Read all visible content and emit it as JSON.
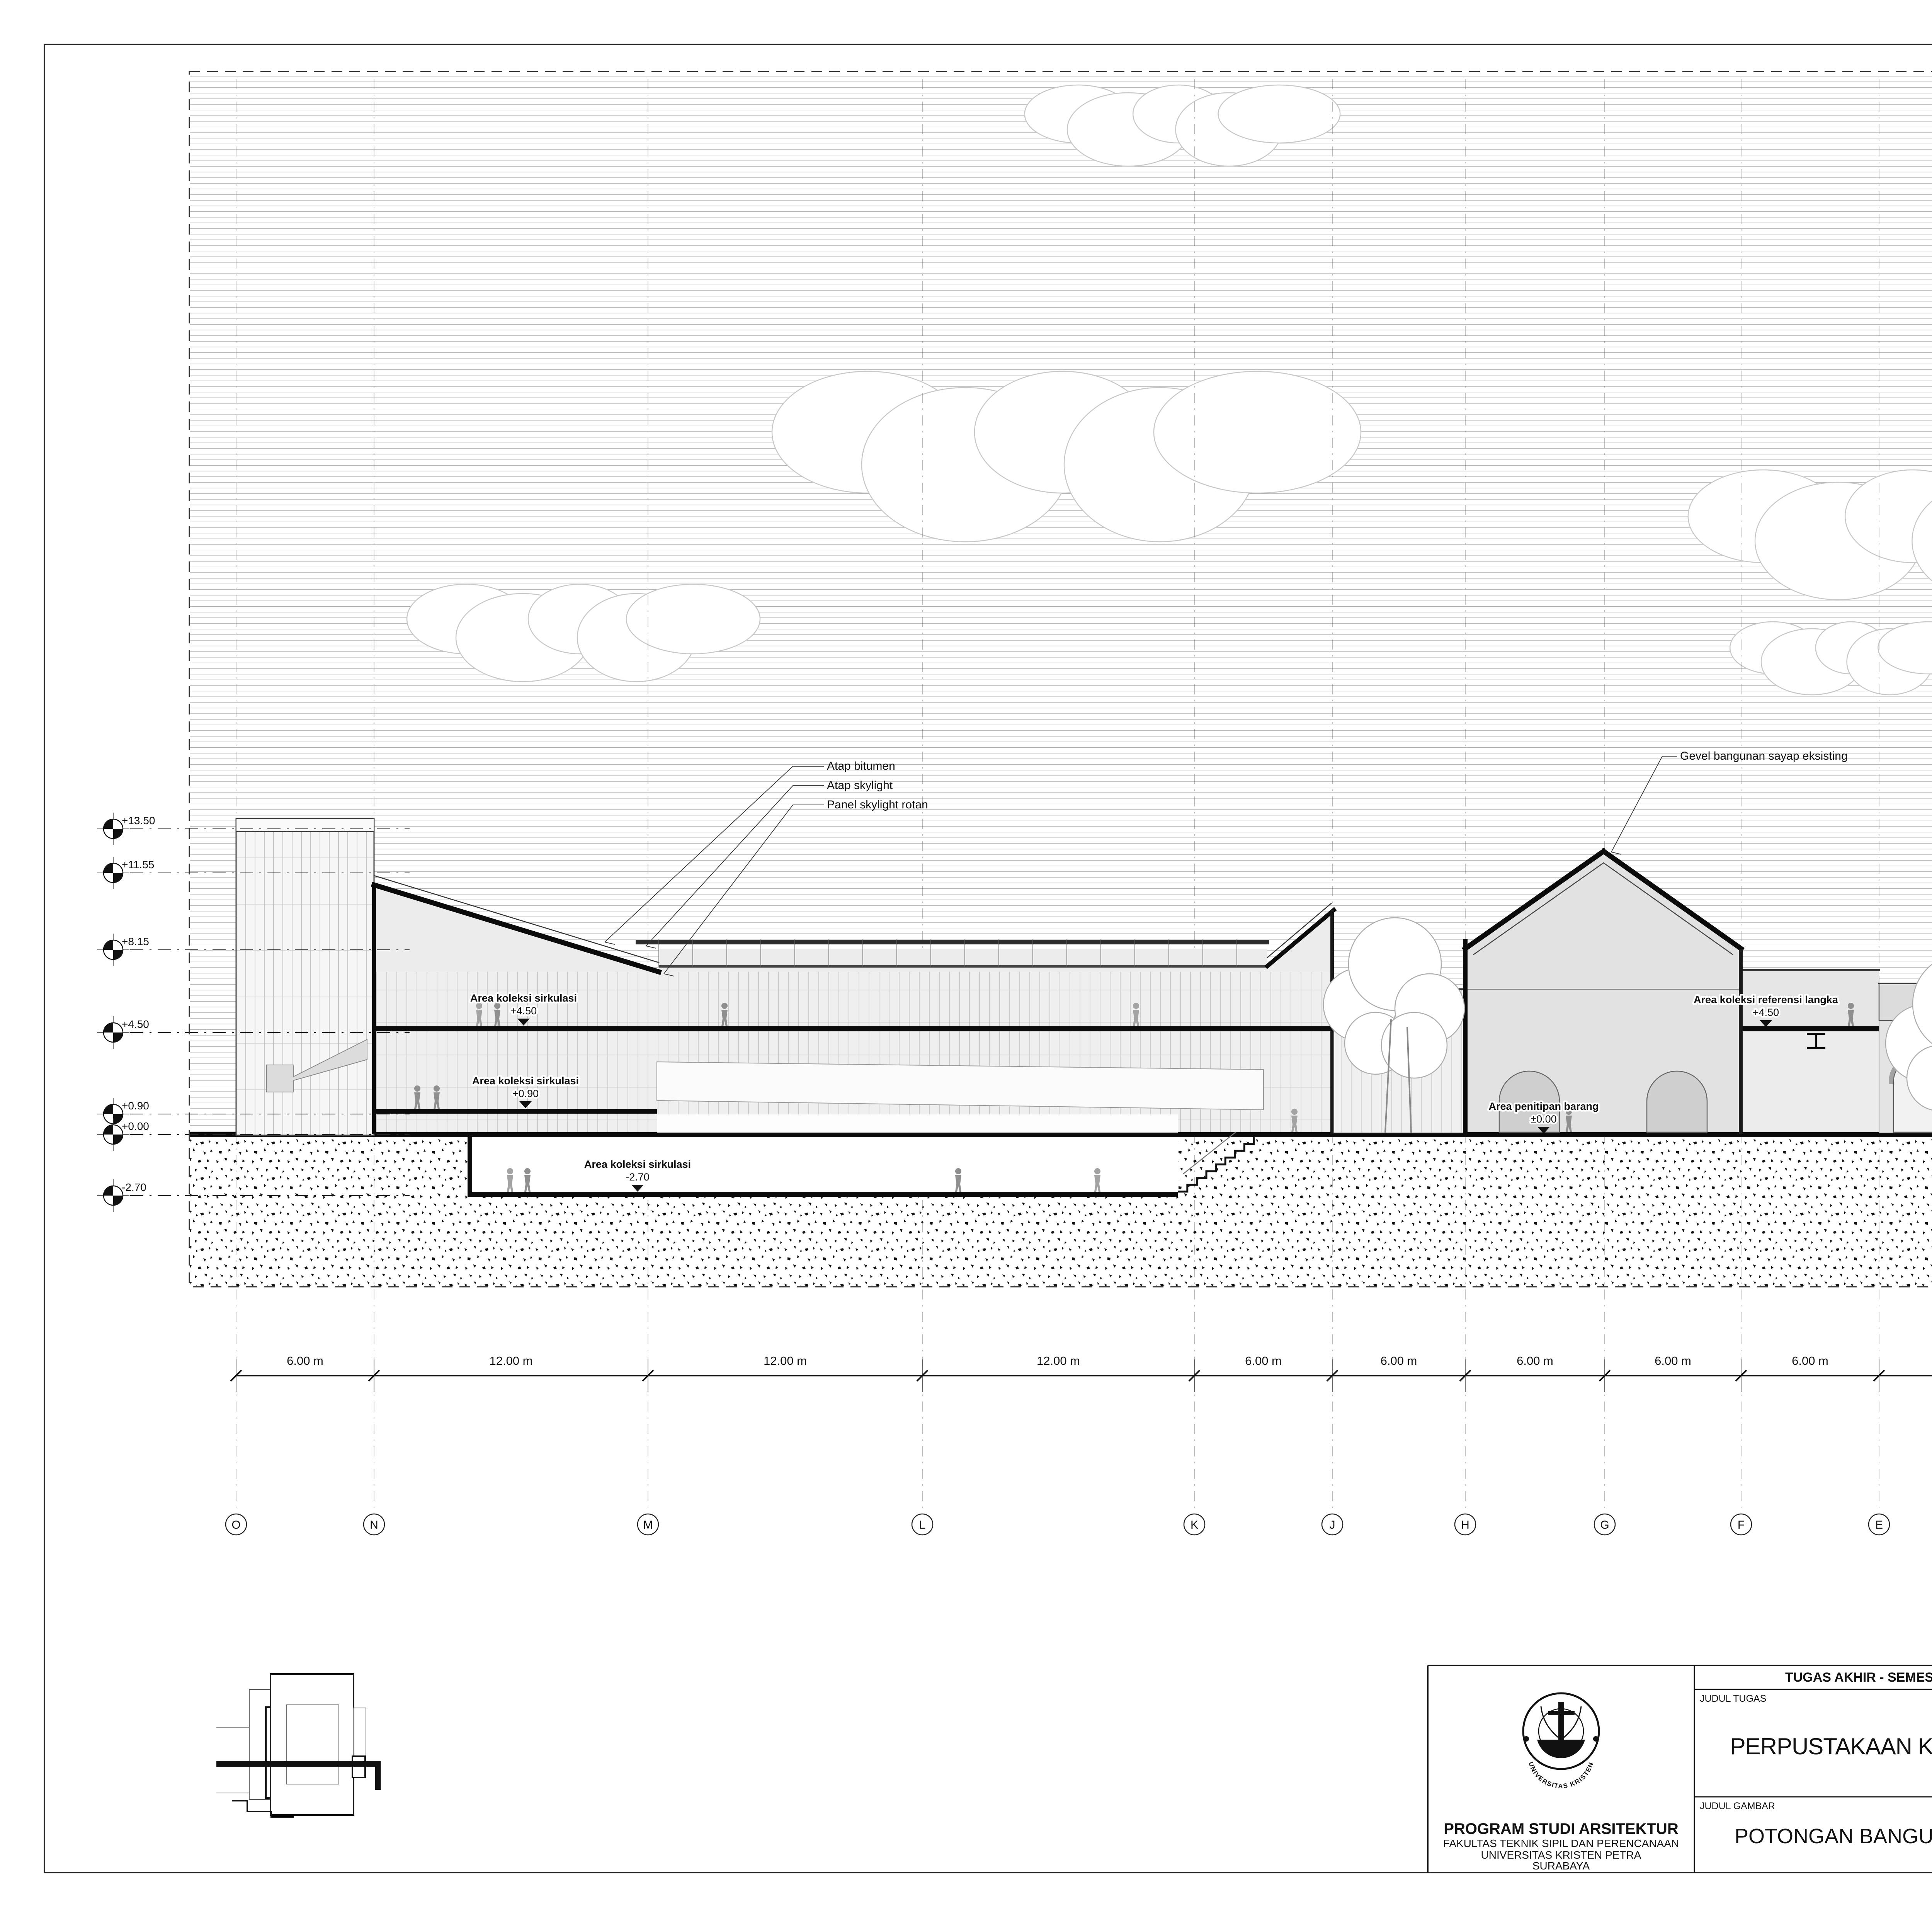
{
  "colors": {
    "paper": "#ffffff",
    "ink": "#111111",
    "sky_hatch": "#ababab",
    "cloud_outline": "#c8c8c8",
    "cut_fill": "#ebebeb",
    "figure_gray": "#8f8f8f"
  },
  "title_block": {
    "header": "TUGAS AKHIR - SEMESTER GENAP 2023/2024",
    "labels": {
      "judul_tugas": "JUDUL TUGAS",
      "judul_gambar": "JUDUL GAMBAR",
      "skala": "SKALA",
      "nama": "NAMA",
      "nrp": "NRP",
      "kelompok": "KELOMPOK",
      "mentor_utama": "MENTOR UTAMA",
      "mentor_pendamping": "MENTOR PENDAMPING",
      "pengesahan": "PENGESAHAN",
      "lembar": "LEMBAR",
      "jumlah": "JUMLAH",
      "tanggal": "TANGGAL"
    },
    "judul_tugas_value": "PERPUSTAKAAN KOTA DI SURABAYA",
    "judul_gambar_value": "POTONGAN BANGUNAN B-B",
    "skala_value": "1:200",
    "nama_value": "JONATHAN LIE PRANATA",
    "nrp_value": "B12200052",
    "kelompok_value": "4",
    "mentor_utama_value": "IR. HANDINOTO, M.T.",
    "mentor_pendamping_values": [
      "ANGELA CHRISTYSONIA TAMPUBOLON, S.T.,M.T.",
      "Dr. FENY ELSIANA, S.T.,M.T."
    ],
    "institution": {
      "line1": "PROGRAM STUDI ARSITEKTUR",
      "line2": "FAKULTAS TEKNIK SIPIL DAN PERENCANAAN",
      "line3": "UNIVERSITAS KRISTEN PETRA",
      "line4": "SURABAYA"
    },
    "logo": {
      "top": "UNIVERSITAS KRISTEN",
      "bottom": "PETRA"
    }
  },
  "annotations": [
    {
      "id": "atap-bitumen",
      "text": "Atap bitumen"
    },
    {
      "id": "atap-skylight",
      "text": "Atap skylight"
    },
    {
      "id": "panel-skylight-rotan",
      "text": "Panel skylight rotan"
    },
    {
      "id": "gevel-sayap",
      "text": "Gevel bangunan sayap eksisting"
    },
    {
      "id": "geveltoppen-kubah",
      "text": "Geveltoppen kubah bangunan eksisting"
    },
    {
      "id": "atap-kubah",
      "text": "Atap kubah bangunan eksisting"
    }
  ],
  "room_labels": [
    {
      "name": "Area koleksi sirkulasi",
      "level": "+4.50"
    },
    {
      "name": "Area koleksi sirkulasi",
      "level": "+0.90"
    },
    {
      "name": "Area koleksi sirkulasi",
      "level": "-2.70"
    },
    {
      "name": "Area penitipan barang",
      "level": "±0.00"
    },
    {
      "name": "Area koleksi referensi langka",
      "level": "+4.50"
    },
    {
      "name": "Kantin",
      "level": "+4.50"
    },
    {
      "name": "Ruang galeri",
      "level": "±0.00"
    },
    {
      "name": "Ruang galeri terbuk",
      "level": "±0.00"
    }
  ],
  "elevations": [
    {
      "label": "+13.50",
      "meters": 13.5
    },
    {
      "label": "+11.55",
      "meters": 11.55
    },
    {
      "label": "+8.15",
      "meters": 8.15
    },
    {
      "label": "+4.50",
      "meters": 4.5
    },
    {
      "label": "+0.90",
      "meters": 0.9
    },
    {
      "label": "+0.00",
      "meters": 0.0
    },
    {
      "label": "-2.70",
      "meters": -2.7
    }
  ],
  "grid": {
    "letters": [
      "O",
      "N",
      "M",
      "L",
      "K",
      "J",
      "H",
      "G",
      "F",
      "E",
      "D",
      "C",
      "B",
      "A"
    ],
    "spans": [
      "6.00 m",
      "12.00 m",
      "12.00 m",
      "12.00 m",
      "6.00 m",
      "6.00 m",
      "6.00 m",
      "6.00 m",
      "6.00 m",
      "12.00 m",
      "6.00 m",
      "6.00 m",
      "6.00 m"
    ]
  }
}
